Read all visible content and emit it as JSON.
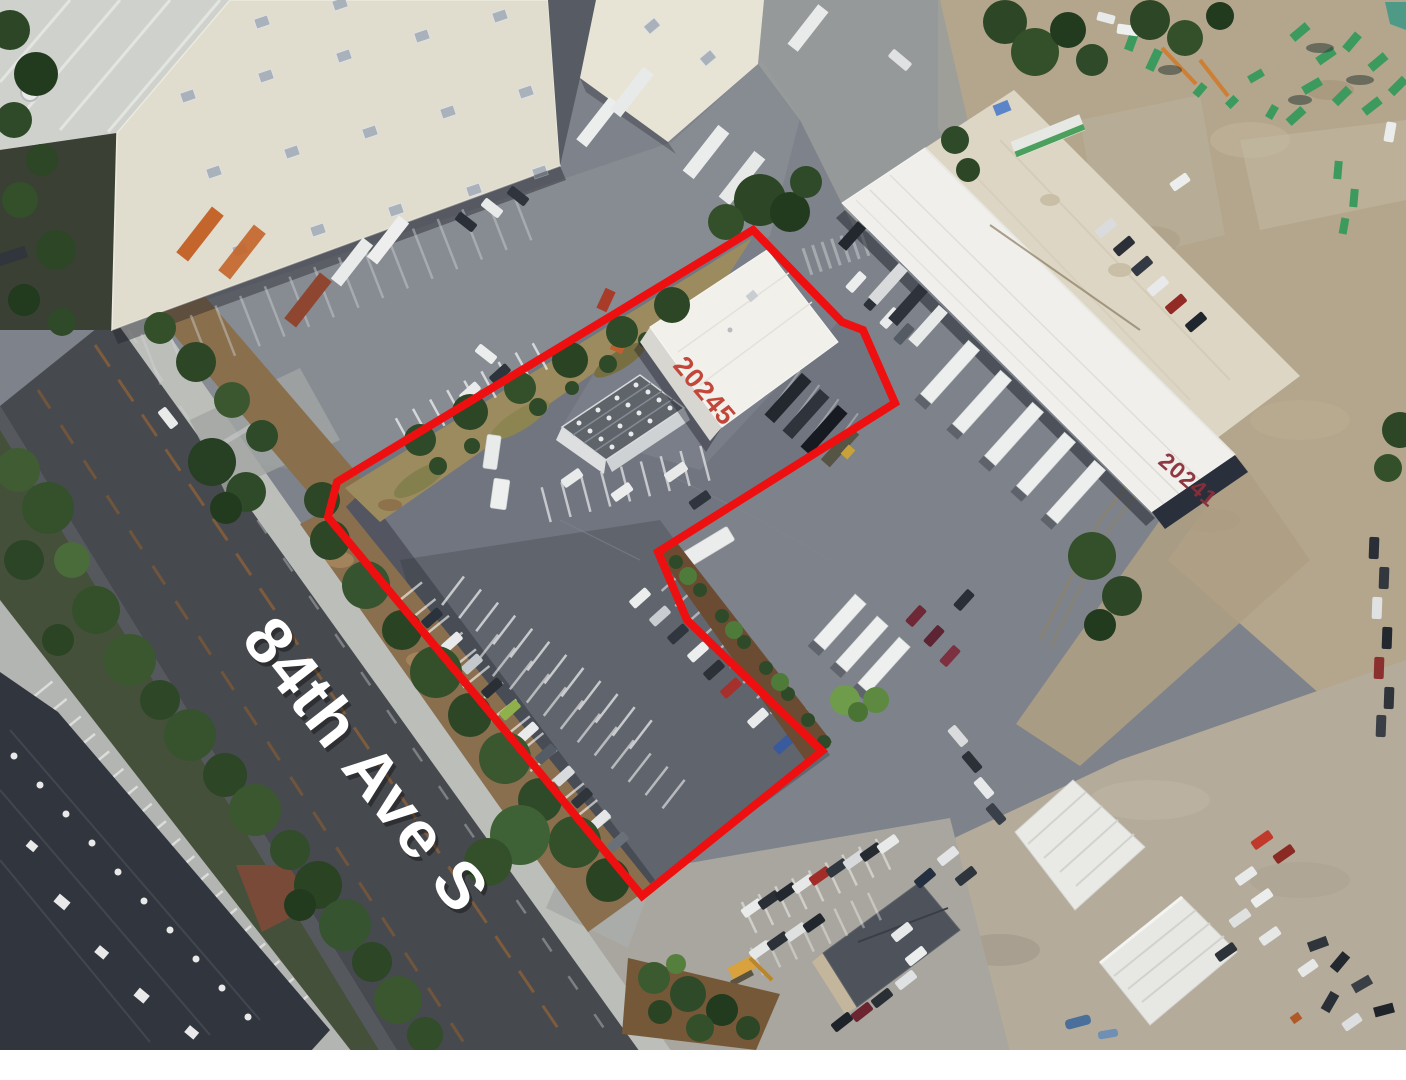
{
  "labels": {
    "street": "84th Ave S",
    "subject_building": "20245",
    "adjacent_building": "20241"
  },
  "colors": {
    "boundary": "#ee1010",
    "street_label": "#ffffff",
    "subject_label": "#c2473a",
    "adjacent_label": "#8a2e3a"
  },
  "boundary": {
    "points": "753,230 842,322 863,330 895,403 658,552 687,620 822,751 642,896 328,517 337,482",
    "stroke_width": 8
  }
}
